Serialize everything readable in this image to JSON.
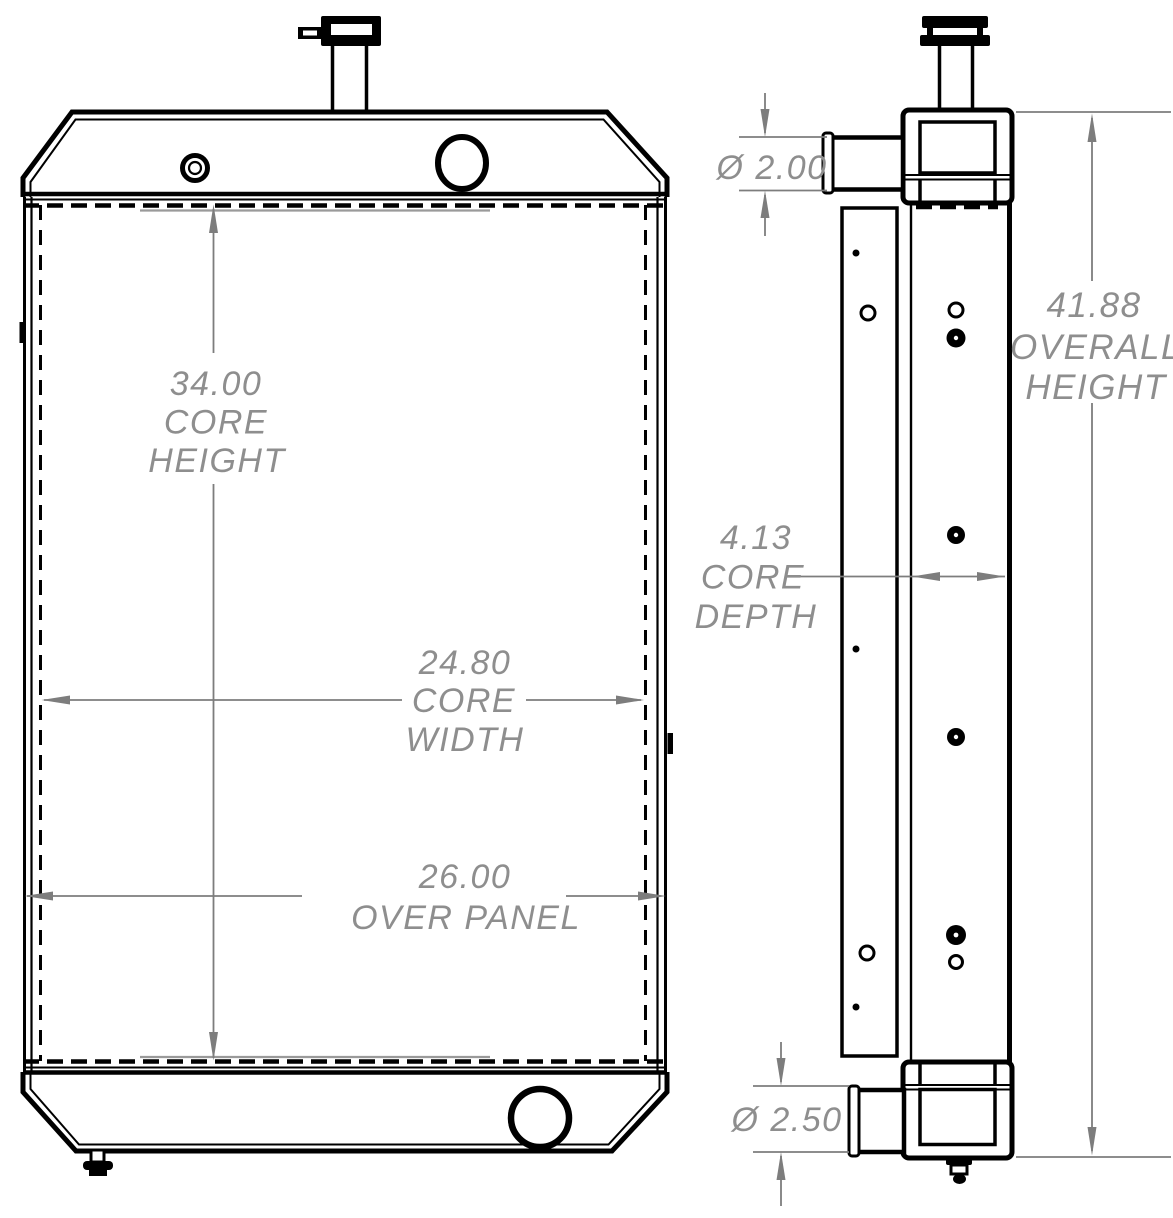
{
  "drawing": {
    "type": "technical-drawing",
    "background": "#ffffff",
    "line_color": "#000000",
    "dimension_color": "#7d7d7d",
    "text_color": "#8e8e8e"
  },
  "front_view": {
    "name": "radiator-front-view",
    "dims": {
      "core_height": {
        "value": "34.00",
        "label1": "CORE",
        "label2": "HEIGHT"
      },
      "core_width": {
        "value": "24.80",
        "label1": "CORE",
        "label2": "WIDTH"
      },
      "over_panel": {
        "value": "26.00",
        "label": "OVER PANEL"
      }
    }
  },
  "side_view": {
    "name": "radiator-side-view",
    "dims": {
      "inlet_diameter": {
        "value": "Ø 2.00"
      },
      "overall_height": {
        "value": "41.88",
        "label1": "OVERALL",
        "label2": "HEIGHT"
      },
      "core_depth": {
        "value": "4.13",
        "label1": "CORE",
        "label2": "DEPTH"
      },
      "outlet_diameter": {
        "value": "Ø 2.50"
      }
    }
  }
}
